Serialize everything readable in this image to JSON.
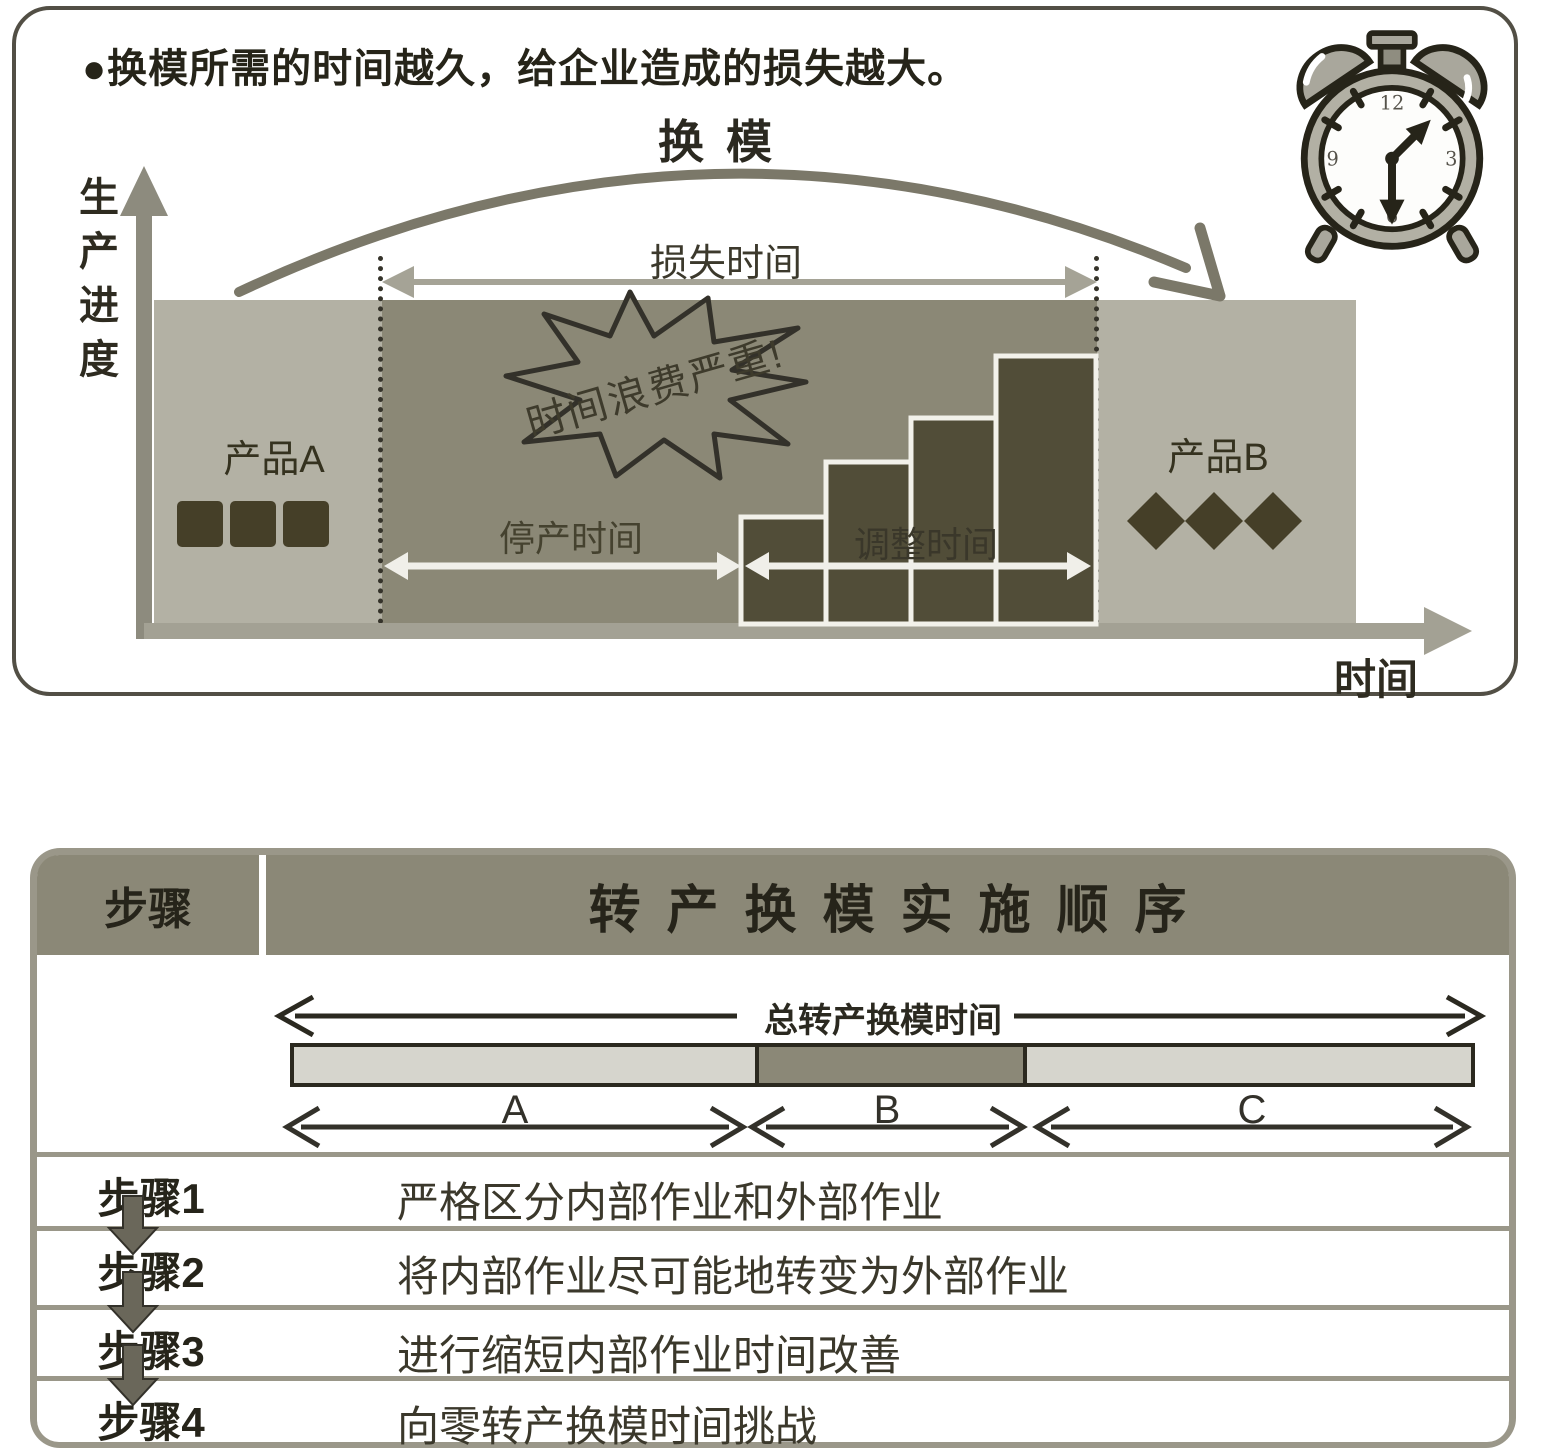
{
  "top_panel": {
    "bullet_text": "●换模所需的时间越久，给企业造成的损失越大。",
    "changeover_label": "换模",
    "y_axis_label": "生产进度",
    "x_axis_label": "时间",
    "loss_time_label": "损失时间",
    "burst_text": "时间浪费严重!",
    "product_a_label": "产品A",
    "product_b_label": "产品B",
    "stop_time_label": "停产时间",
    "adjust_time_label": "调整时间",
    "clock": {
      "n12": "12",
      "n3": "3",
      "n6": "6",
      "n9": "9"
    }
  },
  "table": {
    "header_step": "步骤",
    "header_title": "转产换模实施顺序",
    "total_time_label": "总转产换模时间",
    "segments": [
      {
        "label": "A",
        "share_pct": 39
      },
      {
        "label": "B",
        "share_pct": 23
      },
      {
        "label": "C",
        "share_pct": 38
      }
    ],
    "rows": [
      {
        "step": "步骤1",
        "desc": "严格区分内部作业和外部作业"
      },
      {
        "step": "步骤2",
        "desc": "将内部作业尽可能地转变为外部作业"
      },
      {
        "step": "步骤3",
        "desc": "进行缩短内部作业时间改善"
      },
      {
        "step": "步骤4",
        "desc": "向零转产换模时间挑战"
      }
    ]
  },
  "colors": {
    "panel_border": "#524f45",
    "olive": "#8b8877",
    "light_block": "#b3b1a4",
    "dark_shape": "#453f28",
    "bar_fill": "#514d38",
    "axis_gray": "#8d8b7e",
    "arc_gray": "#7b7869",
    "table_border": "#9a9789",
    "segment_light": "#d6d5cd"
  }
}
